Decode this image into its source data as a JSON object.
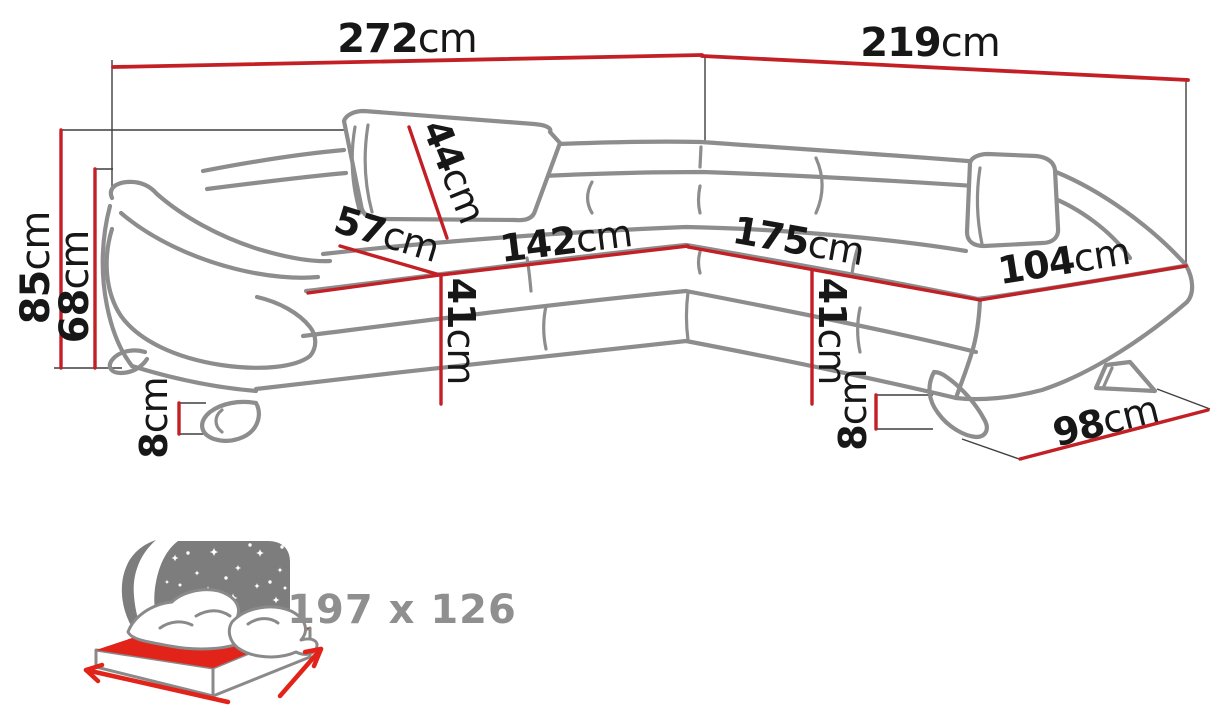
{
  "diagram": {
    "product": "corner-sofa-dimension-diagram",
    "colors": {
      "dimension_red": "#c32026",
      "sketch_gray": "#8d8d8d",
      "label_black": "#171717",
      "label_gray": "#8f8f8f",
      "icon_red": "#e2231a",
      "icon_gray": "#7d7d7d"
    },
    "dimensions": {
      "total_width": {
        "num": "272",
        "unit": "cm"
      },
      "total_depth": {
        "num": "219",
        "unit": "cm"
      },
      "total_height": {
        "num": "85",
        "unit": "cm"
      },
      "backrest_height": {
        "num": "68",
        "unit": "cm"
      },
      "headrest_height": {
        "num": "44",
        "unit": "cm"
      },
      "seat_depth": {
        "num": "57",
        "unit": "cm"
      },
      "left_seat_width": {
        "num": "142",
        "unit": "cm"
      },
      "right_seat_width": {
        "num": "175",
        "unit": "cm"
      },
      "chaise_seat_width": {
        "num": "104",
        "unit": "cm"
      },
      "seat_height_left": {
        "num": "41",
        "unit": "cm"
      },
      "seat_height_right": {
        "num": "41",
        "unit": "cm"
      },
      "leg_height_left": {
        "num": "8",
        "unit": "cm"
      },
      "leg_height_right": {
        "num": "8",
        "unit": "cm"
      },
      "chaise_depth": {
        "num": "98",
        "unit": "cm"
      }
    },
    "sleeping_function": {
      "icon": "bed-moon-stars-icon",
      "area_label": "197 x 126"
    }
  }
}
